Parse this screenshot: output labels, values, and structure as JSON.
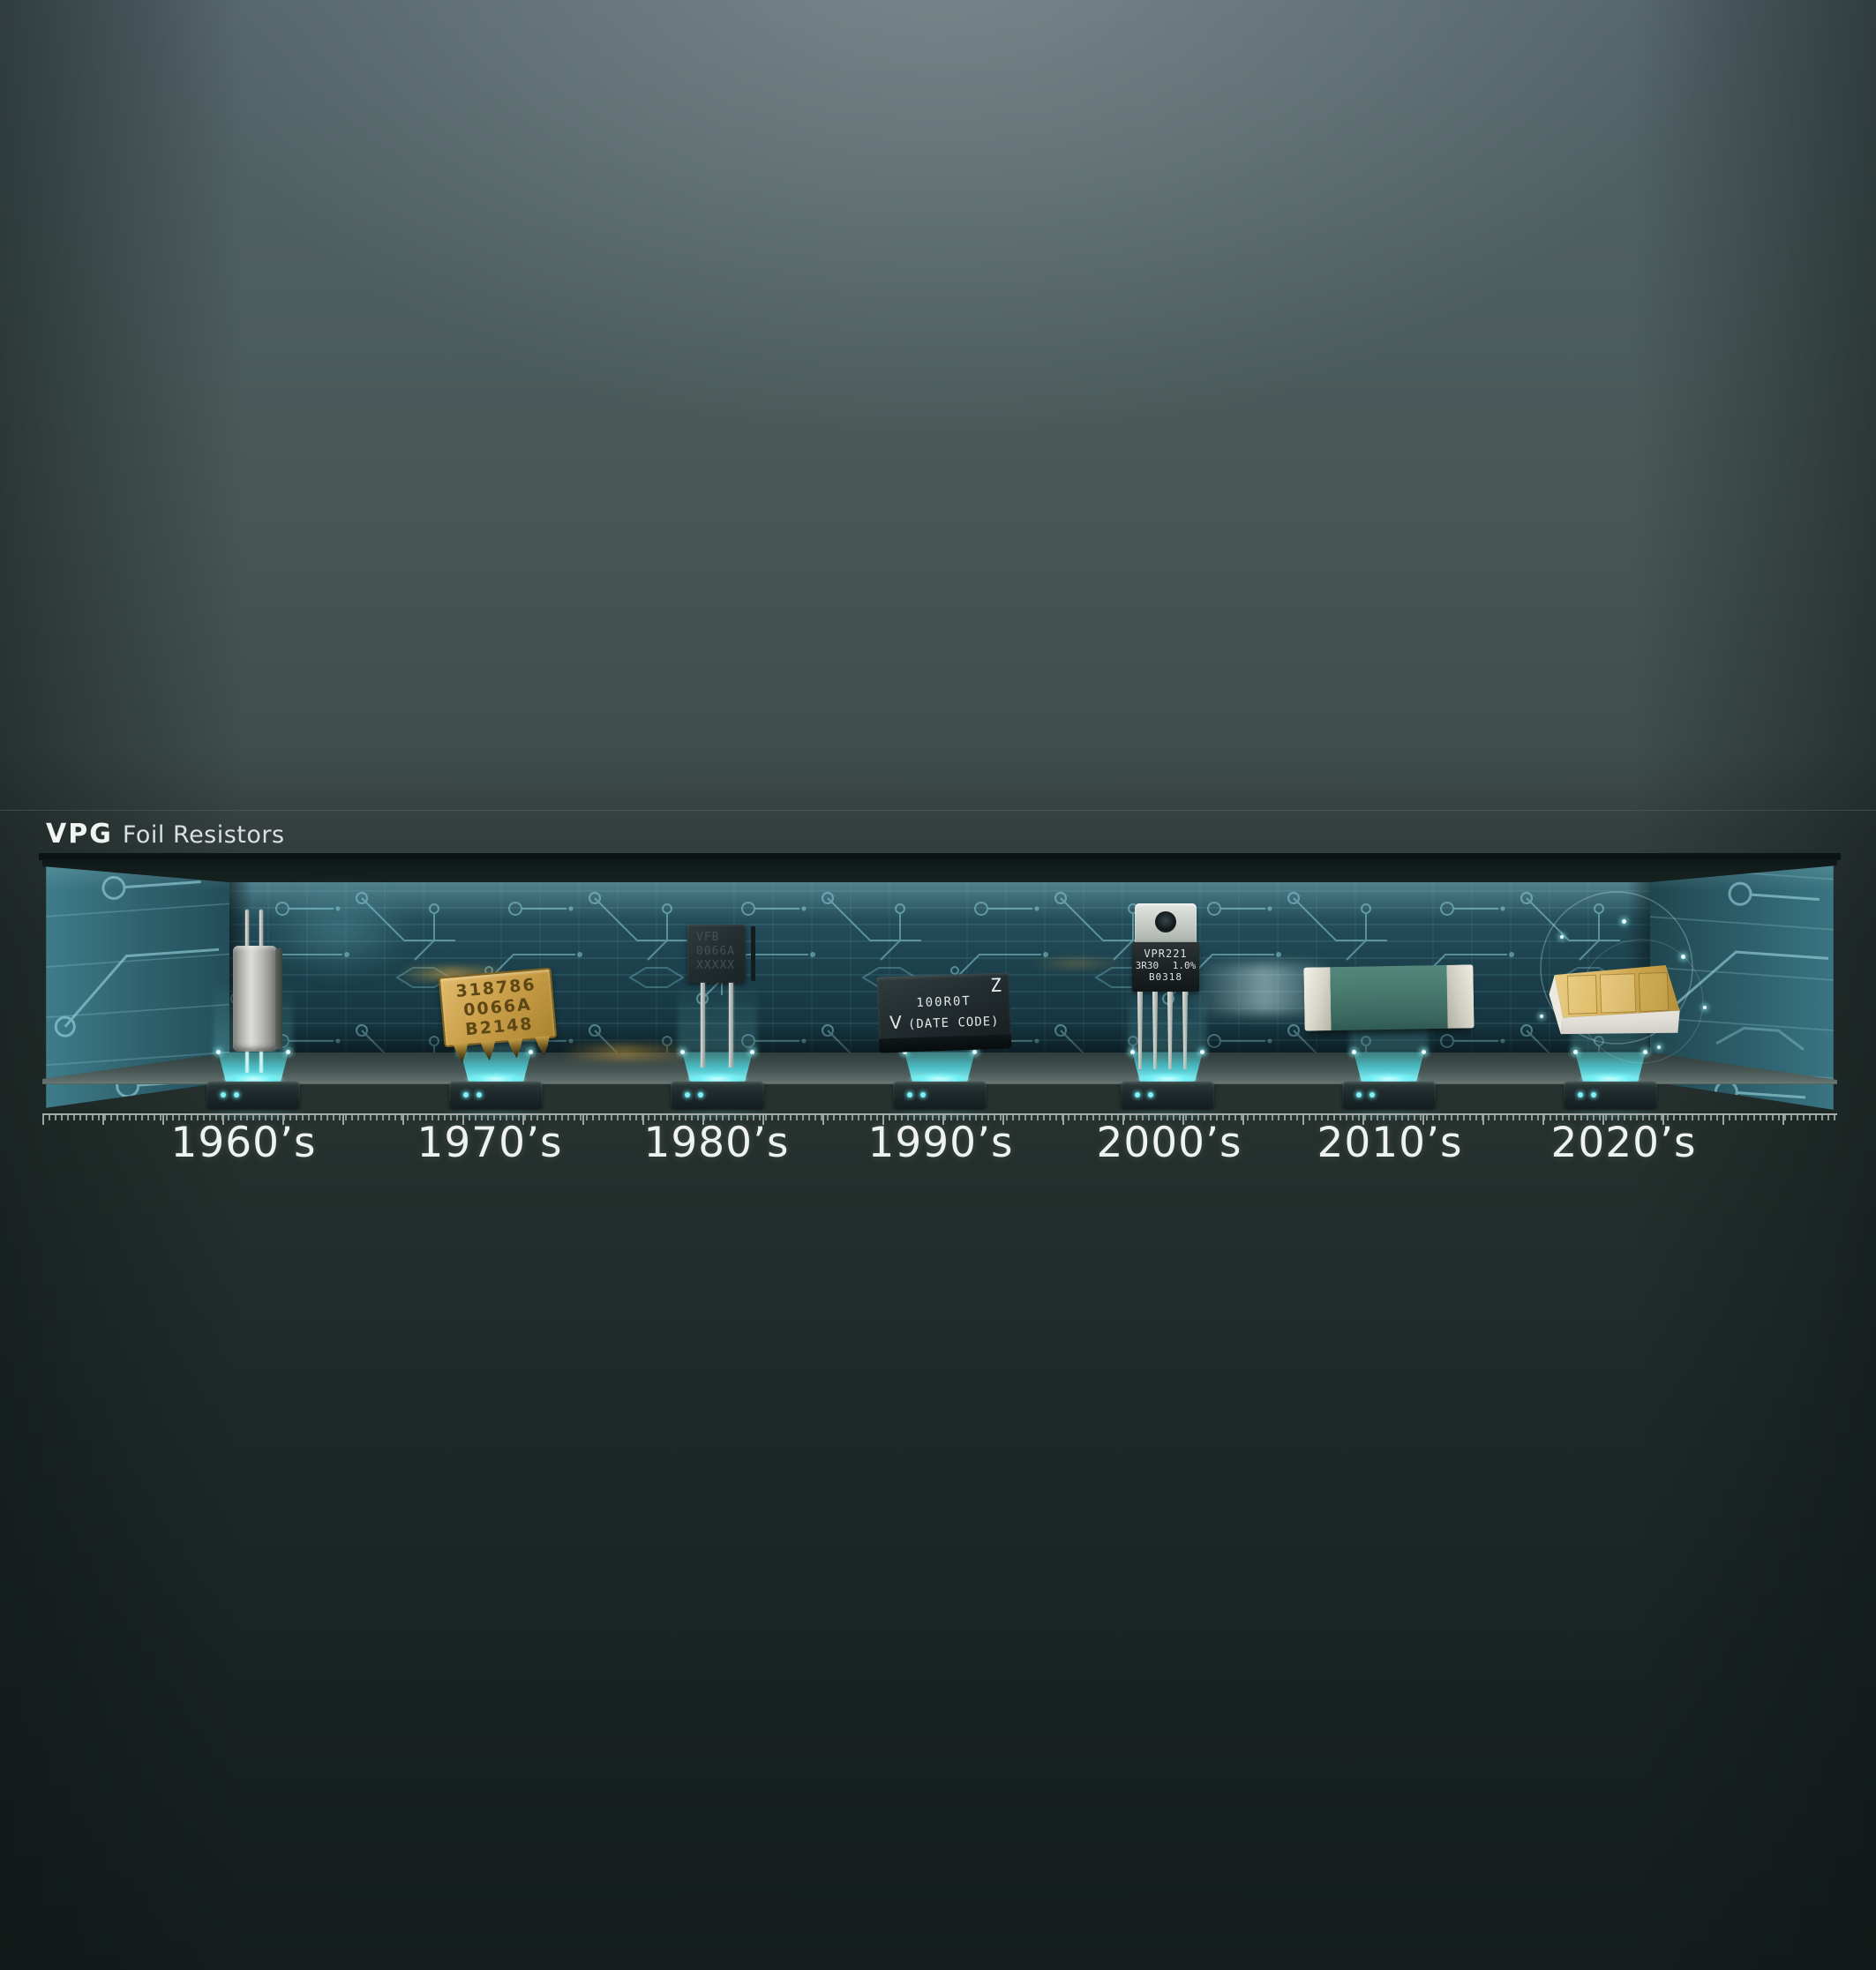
{
  "logo": {
    "brand": "VPG",
    "name": "Foil Resistors"
  },
  "decades": [
    {
      "label": "1960’s",
      "component": "metal-can-resistor"
    },
    {
      "label": "1970’s",
      "component": "gold-dip-resistor-network",
      "marks": [
        "318786",
        "0066A",
        "B2148"
      ]
    },
    {
      "label": "1980’s",
      "component": "boxed-radial-lead-resistor",
      "marks": [
        "VFB",
        "0066A",
        "XXXXX"
      ]
    },
    {
      "label": "1990’s",
      "component": "molded-smd-resistor",
      "z": "Z",
      "value": "100R0T",
      "v": "V",
      "date": "(DATE CODE)"
    },
    {
      "label": "2000’s",
      "component": "to220-power-resistor",
      "marks": [
        "VPR221",
        "3R30 1.0%",
        "B0318"
      ]
    },
    {
      "label": "2010’s",
      "component": "green-chip-resistor"
    },
    {
      "label": "2020’s",
      "component": "gold-ceramic-module"
    }
  ],
  "colors": {
    "accent_cyan": "#5beef2",
    "wall_teal": "#1e4450",
    "circuit_line": "#8fd8e2",
    "gold": "#cca04b",
    "label_white": "#eef3f2"
  }
}
